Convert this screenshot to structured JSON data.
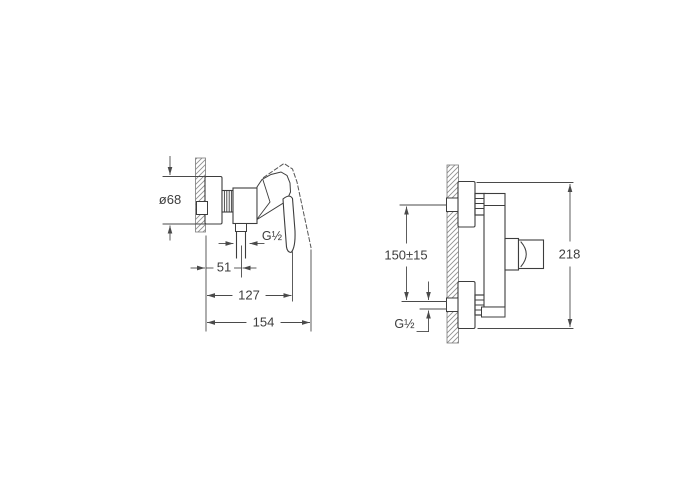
{
  "side_view": {
    "diameter_label": "ø68",
    "outlet_thread_label": "G½",
    "wall_to_outlet_label": "51",
    "depth_to_handle_label": "127",
    "max_depth_label": "154"
  },
  "front_view": {
    "inlet_spacing_label": "150±15",
    "inlet_thread_label": "G½",
    "overall_height_label": "218"
  },
  "colors": {
    "line": "#3d3d3d",
    "dimension_line": "#4a4a4a",
    "hatch": "#8f8f8f",
    "background": "#ffffff"
  }
}
